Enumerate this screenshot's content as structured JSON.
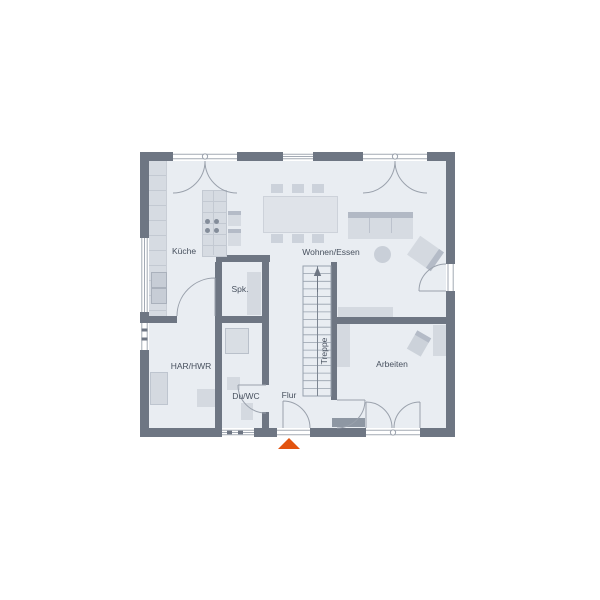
{
  "plan": {
    "rooms": {
      "kueche": "Küche",
      "spk": "Spk.",
      "har_hwr": "HAR/HWR",
      "du_wc": "Du/WC",
      "flur": "Flur",
      "treppe": "Treppe",
      "wohnen_essen": "Wohnen/Essen",
      "arbeiten": "Arbeiten"
    },
    "markers": {
      "entrance": "orange-triangle-up"
    },
    "colors": {
      "wall": "#6e7683",
      "floor": "#e9edf2",
      "furniture_light": "#d6dbe2",
      "furniture_medium": "#c7cdd6",
      "furniture_dark": "#8e97a3",
      "symbol_line": "#9aa1ac",
      "text": "#47505e",
      "entrance_marker": "#e2530f",
      "background": "#ffffff"
    }
  }
}
